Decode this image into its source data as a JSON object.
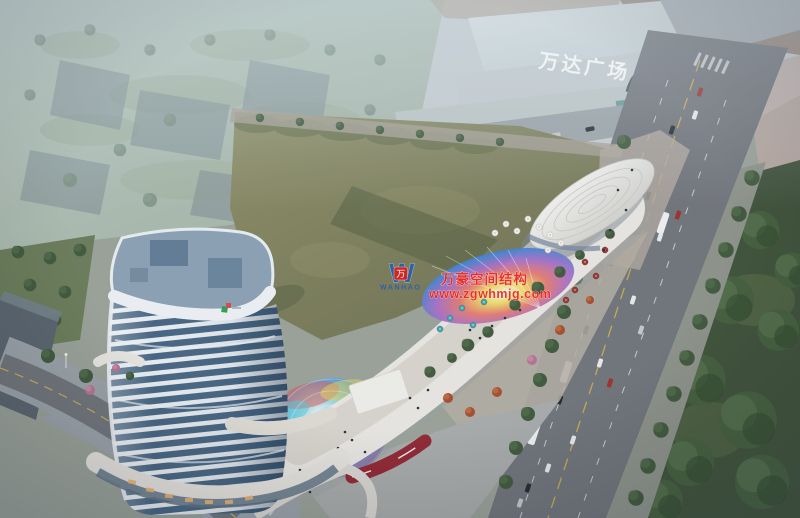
{
  "signs": {
    "mall": {
      "text": "万达广场",
      "color": "#f2f6f7"
    }
  },
  "watermark": {
    "brand_cn": "万豪空间结构",
    "website": "www.zgwhmjg.com",
    "text_color": "#e8281e",
    "logo_color": "#2a5fae",
    "badge_color": "#d42420",
    "logo": {
      "letter": "W",
      "badge": "万",
      "name": "WANHAO"
    }
  },
  "palette": {
    "field_light": "#8d8d64",
    "field_dark": "#6b6e4e",
    "park": "#3c4f36",
    "road": "#6e7177",
    "strip_white": "#e9e6e1",
    "tower_glass": "#42617f",
    "tower_slab": "#e9edf1",
    "mall_light": "#c6cdd0",
    "led_red": "#90222f",
    "dome_blue": "#3b7fd4",
    "dome_cyan": "#58c8d8",
    "canopy_yellow": "#ecd95c",
    "canopy_red": "#e0706a",
    "canopy_purple": "#9a63c0"
  }
}
